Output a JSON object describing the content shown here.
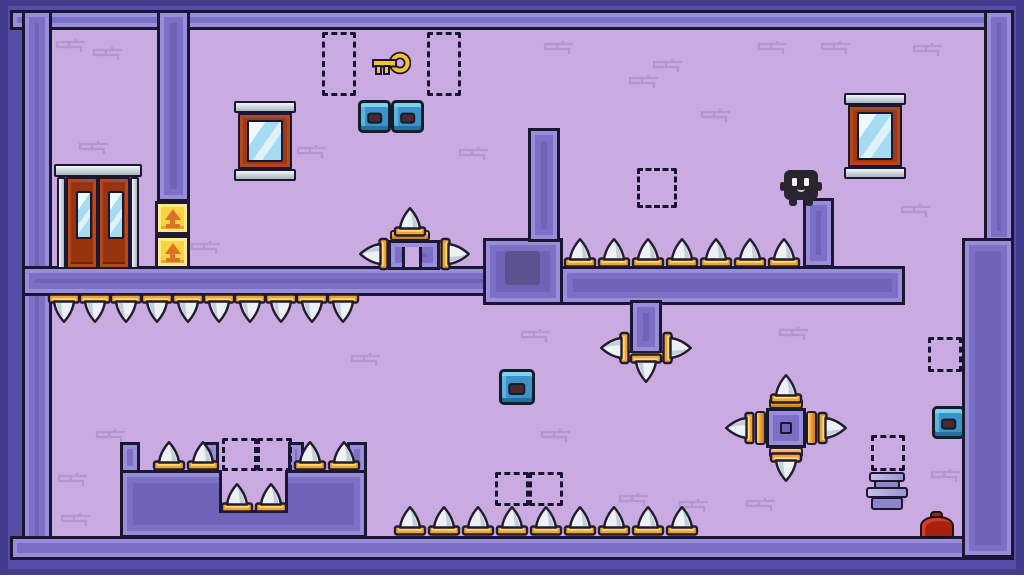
{
  "app": {
    "type": "pixel-art platformer level",
    "description": "single-screen purple dungeon room with spikes, doors, crates and a player character"
  },
  "colors": {
    "outer_edge": "#433c8e",
    "outer": "#564ea6",
    "wall_core": "#6e63b8",
    "wall_mid": "#7b70c6",
    "wall_light": "#998eda",
    "outline": "#1b1733",
    "room": "#c9abe1",
    "brick": "#ab8ecd",
    "spike_white": "#edf1f4",
    "spike_shade": "#c3ced8",
    "gold": "#f0a23a",
    "gold_light": "#ffd96a",
    "gold_dark": "#c97b16",
    "crate_yellow": "#f7d243",
    "crate_arrow": "#dd7226",
    "door_red": "#97340f",
    "silver": "#dfe6ea",
    "glass_blue": "#a5dcf2",
    "box_blue": "#3b93c7",
    "box_inner": "#4c2831",
    "key_gold": "#f2c521",
    "slot": "#5a538f",
    "dash": "#171430",
    "canister_light": "#b2abdf",
    "canister_mid": "#8d86c9",
    "blob_red": "#a6220f",
    "player_body": "#29252f"
  },
  "level": {
    "walls": [
      {
        "name": "wall-top",
        "x": 10,
        "y": 10,
        "w": 1004,
        "h": 20
      },
      {
        "name": "wall-left",
        "x": 22,
        "y": 10,
        "w": 30,
        "h": 548
      },
      {
        "name": "wall-bottom",
        "x": 10,
        "y": 536,
        "w": 1004,
        "h": 24
      },
      {
        "name": "wall-right-upper",
        "x": 984,
        "y": 10,
        "w": 30,
        "h": 234
      },
      {
        "name": "wall-right-lower",
        "x": 962,
        "y": 238,
        "w": 52,
        "h": 320
      },
      {
        "name": "pillar-top-left",
        "x": 157,
        "y": 10,
        "w": 33,
        "h": 192
      },
      {
        "name": "divider-left",
        "x": 22,
        "y": 266,
        "w": 475,
        "h": 30
      },
      {
        "name": "center-block",
        "x": 483,
        "y": 238,
        "w": 80,
        "h": 67
      },
      {
        "name": "finger-pillar",
        "x": 528,
        "y": 128,
        "w": 32,
        "h": 114
      },
      {
        "name": "divider-right",
        "x": 560,
        "y": 266,
        "w": 345,
        "h": 39
      },
      {
        "name": "character-pillar",
        "x": 803,
        "y": 198,
        "w": 31,
        "h": 70
      },
      {
        "name": "hanging-pillar",
        "x": 630,
        "y": 300,
        "w": 32,
        "h": 54
      },
      {
        "name": "platform-body",
        "x": 120,
        "y": 470,
        "w": 247,
        "h": 68
      },
      {
        "name": "platform-cap-left",
        "x": 120,
        "y": 442,
        "w": 20,
        "h": 31
      },
      {
        "name": "platform-cap-right",
        "x": 347,
        "y": 442,
        "w": 20,
        "h": 31
      },
      {
        "name": "pit-rim-left",
        "x": 203,
        "y": 442,
        "w": 16,
        "h": 31
      },
      {
        "name": "pit-rim-right",
        "x": 288,
        "y": 442,
        "w": 16,
        "h": 31
      },
      {
        "name": "pedestal",
        "x": 388,
        "y": 240,
        "w": 52,
        "h": 30
      }
    ],
    "cutouts": [
      {
        "name": "pit",
        "x": 219,
        "y": 470,
        "w": 69,
        "h": 43
      },
      {
        "name": "pedestal-notch",
        "x": 402,
        "y": 247,
        "w": 20,
        "h": 23
      }
    ],
    "slot": {
      "name": "dark-doorway",
      "x": 505,
      "y": 251,
      "w": 35,
      "h": 34
    },
    "spike_rows": [
      {
        "name": "spikes-mid-floor",
        "x": 563,
        "y": 238,
        "count": 7,
        "spacing": 34,
        "dir": "up"
      },
      {
        "name": "spikes-ceiling-left",
        "x": 47,
        "y": 293,
        "count": 10,
        "spacing": 31,
        "dir": "down"
      },
      {
        "name": "spikes-bottom-floor",
        "x": 393,
        "y": 506,
        "count": 9,
        "spacing": 34,
        "dir": "up"
      },
      {
        "name": "spikes-platform-a",
        "x": 152,
        "y": 441,
        "count": 2,
        "spacing": 34,
        "dir": "up"
      },
      {
        "name": "spikes-platform-b",
        "x": 293,
        "y": 441,
        "count": 2,
        "spacing": 34,
        "dir": "up"
      },
      {
        "name": "spikes-pit",
        "x": 220,
        "y": 483,
        "count": 2,
        "spacing": 34,
        "dir": "up"
      }
    ],
    "spike_singles": [
      {
        "name": "pedestal-spike-up",
        "cx": 410,
        "cy": 222,
        "dir": "up"
      },
      {
        "name": "pedestal-spike-left",
        "cx": 374,
        "cy": 254,
        "dir": "left"
      },
      {
        "name": "pedestal-spike-right",
        "cx": 455,
        "cy": 254,
        "dir": "right"
      },
      {
        "name": "hang-spike-down",
        "cx": 646,
        "cy": 368,
        "dir": "down"
      },
      {
        "name": "hang-spike-left",
        "cx": 615,
        "cy": 348,
        "dir": "left"
      },
      {
        "name": "hang-spike-right",
        "cx": 677,
        "cy": 348,
        "dir": "right"
      },
      {
        "name": "cross-spike-up",
        "cx": 786,
        "cy": 389,
        "dir": "up"
      },
      {
        "name": "cross-spike-down",
        "cx": 786,
        "cy": 467,
        "dir": "down"
      },
      {
        "name": "cross-spike-left",
        "cx": 740,
        "cy": 428,
        "dir": "left"
      },
      {
        "name": "cross-spike-right",
        "cx": 832,
        "cy": 428,
        "dir": "right"
      }
    ],
    "gold_bands": [
      {
        "name": "pedestal-mount-top",
        "x": 390,
        "y": 230,
        "w": 40,
        "h": 11,
        "v": false
      },
      {
        "name": "pedestal-mount-left",
        "x": 380,
        "y": 240,
        "w": 10,
        "h": 29,
        "v": true
      },
      {
        "name": "pedestal-mount-right",
        "x": 438,
        "y": 240,
        "w": 10,
        "h": 29,
        "v": true
      },
      {
        "name": "hang-mount-left",
        "x": 619,
        "y": 334,
        "w": 10,
        "h": 28,
        "v": true
      },
      {
        "name": "hang-mount-right",
        "x": 663,
        "y": 334,
        "w": 10,
        "h": 28,
        "v": true
      },
      {
        "name": "hang-mount-bottom",
        "x": 624,
        "y": 351,
        "w": 44,
        "h": 11,
        "v": false
      },
      {
        "name": "cross-mount-top",
        "x": 769,
        "y": 398,
        "w": 34,
        "h": 11,
        "v": false
      },
      {
        "name": "cross-mount-bottom",
        "x": 769,
        "y": 447,
        "w": 34,
        "h": 11,
        "v": false
      },
      {
        "name": "cross-mount-left",
        "x": 755,
        "y": 411,
        "w": 11,
        "h": 34,
        "v": true
      },
      {
        "name": "cross-mount-right",
        "x": 806,
        "y": 411,
        "w": 11,
        "h": 34,
        "v": true
      }
    ],
    "spike_cross": {
      "name": "floating-spike-cross",
      "core": {
        "x": 766,
        "y": 408,
        "w": 40,
        "h": 40
      },
      "inner": {
        "x": 780,
        "y": 422,
        "w": 12,
        "h": 12
      }
    },
    "objects": {
      "door": {
        "name": "double-door",
        "x": 54,
        "y": 164,
        "w": 88,
        "h": 105
      },
      "mirrors": [
        {
          "name": "mirror-left",
          "x": 234,
          "y": 101,
          "w": 62,
          "h": 80
        },
        {
          "name": "mirror-right",
          "x": 844,
          "y": 93,
          "w": 62,
          "h": 86
        }
      ],
      "crates": [
        {
          "name": "arrow-crate-top",
          "x": 155,
          "y": 201,
          "w": 35,
          "h": 34
        },
        {
          "name": "arrow-crate-bottom",
          "x": 155,
          "y": 235,
          "w": 35,
          "h": 34
        }
      ],
      "key": {
        "name": "gold-key",
        "x": 371,
        "y": 50,
        "w": 40,
        "h": 30
      },
      "blue_boxes": [
        {
          "name": "blue-box-1",
          "x": 358,
          "y": 100,
          "s": 33
        },
        {
          "name": "blue-box-2",
          "x": 391,
          "y": 100,
          "s": 33
        },
        {
          "name": "blue-box-3",
          "x": 499,
          "y": 369,
          "s": 36
        },
        {
          "name": "blue-box-4",
          "x": 932,
          "y": 406,
          "s": 33
        }
      ],
      "dashed_markers": [
        {
          "name": "marker-key-left",
          "x": 322,
          "y": 32,
          "w": 34,
          "h": 64
        },
        {
          "name": "marker-key-right",
          "x": 427,
          "y": 32,
          "w": 34,
          "h": 64
        },
        {
          "name": "marker-mid-air",
          "x": 637,
          "y": 168,
          "w": 40,
          "h": 40
        },
        {
          "name": "marker-platform-left",
          "x": 222,
          "y": 438,
          "w": 35,
          "h": 33
        },
        {
          "name": "marker-platform-right",
          "x": 257,
          "y": 438,
          "w": 35,
          "h": 33
        },
        {
          "name": "marker-floor-left",
          "x": 495,
          "y": 472,
          "w": 34,
          "h": 34
        },
        {
          "name": "marker-floor-right",
          "x": 529,
          "y": 472,
          "w": 34,
          "h": 34
        },
        {
          "name": "marker-right-shaft",
          "x": 928,
          "y": 337,
          "w": 34,
          "h": 35
        },
        {
          "name": "marker-canister",
          "x": 871,
          "y": 435,
          "w": 34,
          "h": 36
        }
      ],
      "canister": {
        "name": "canister",
        "x": 866,
        "y": 472,
        "w": 42,
        "h": 38
      },
      "blob": {
        "name": "red-slime",
        "x": 920,
        "y": 511,
        "w": 34,
        "h": 27
      },
      "player": {
        "name": "player-character",
        "x": 784,
        "y": 170,
        "w": 34,
        "h": 36
      }
    },
    "decor_bricks": [
      [
        55,
        38
      ],
      [
        92,
        46
      ],
      [
        78,
        140
      ],
      [
        296,
        144
      ],
      [
        458,
        146
      ],
      [
        543,
        40
      ],
      [
        628,
        74
      ],
      [
        700,
        108
      ],
      [
        757,
        40
      ],
      [
        820,
        40
      ],
      [
        912,
        42
      ],
      [
        900,
        203
      ],
      [
        652,
        58
      ],
      [
        190,
        240
      ],
      [
        350,
        352
      ],
      [
        520,
        328
      ],
      [
        778,
        326
      ],
      [
        95,
        428
      ],
      [
        540,
        428
      ],
      [
        618,
        492
      ],
      [
        678,
        498
      ],
      [
        745,
        497
      ],
      [
        930,
        468
      ],
      [
        878,
        488
      ],
      [
        57,
        472
      ],
      [
        60,
        512
      ]
    ]
  }
}
